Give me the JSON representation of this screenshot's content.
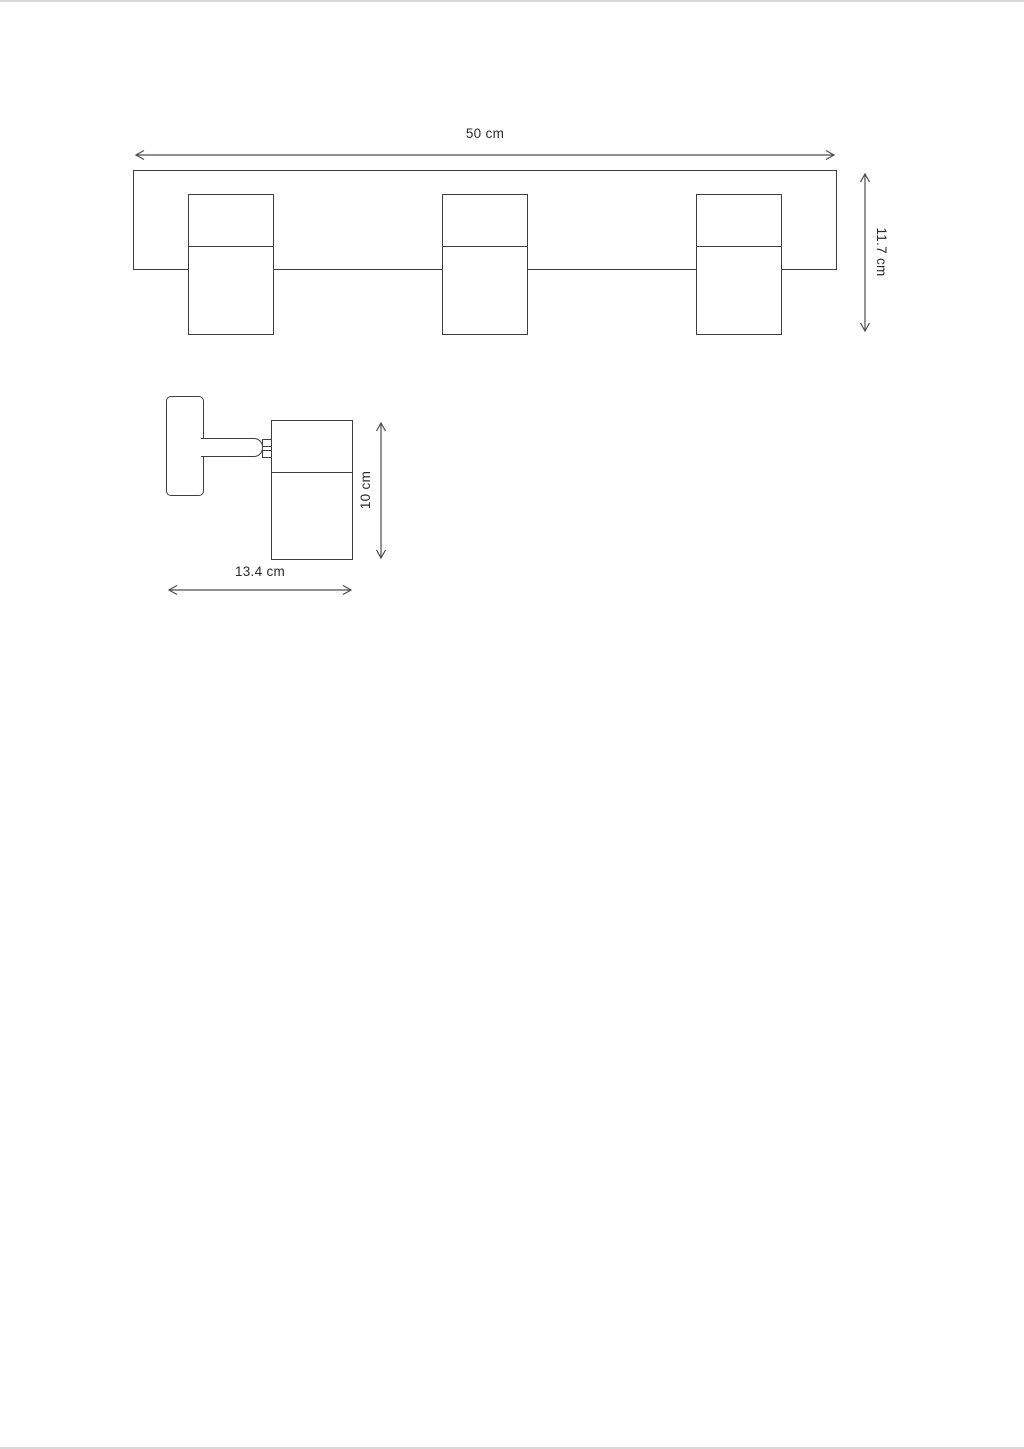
{
  "page": {
    "background": "#ffffff",
    "drawing_line_color": "#3e3e3e",
    "dimension_line_color": "#4d4d4d",
    "text_color": "#2b2b2b",
    "page_edge_color": "#d8d8d8"
  },
  "front_view": {
    "spot_count": 3,
    "width_dimension": "50 cm",
    "height_dimension": "11.7 cm"
  },
  "side_view": {
    "height_dimension": "10 cm",
    "width_dimension": "13.4 cm"
  }
}
